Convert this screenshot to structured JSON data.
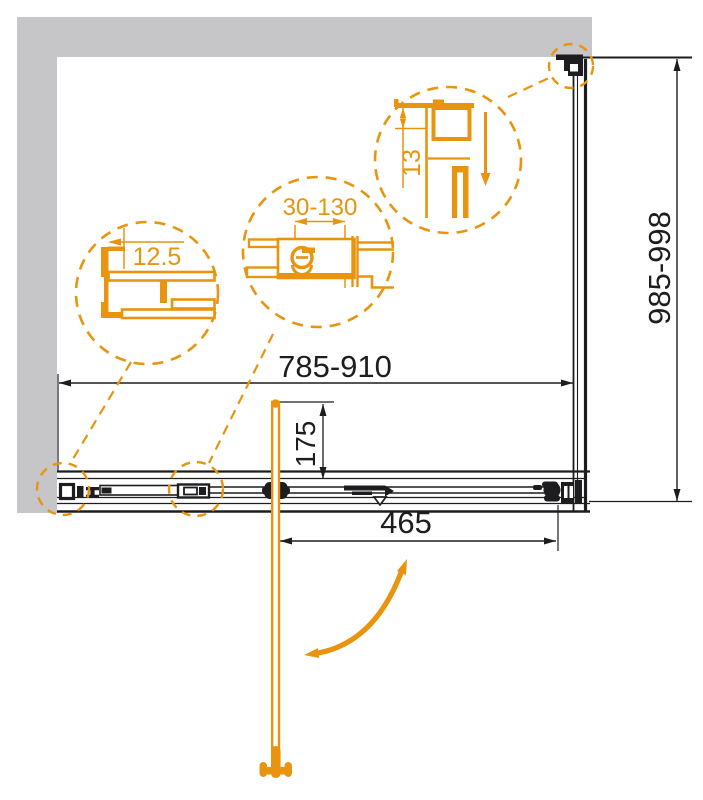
{
  "dimensions": {
    "overall_width": "785-910",
    "overall_depth": "985-998",
    "door_opening": "465",
    "handle_inset": "175"
  },
  "details": {
    "wall_profile_width": "12.5",
    "adjustment_range": "30-130",
    "top_profile_gap": "13"
  },
  "colors": {
    "accent_orange": "#e8940e",
    "line_black": "#1d1d1f",
    "wall_gray": "#c6c6c8"
  }
}
